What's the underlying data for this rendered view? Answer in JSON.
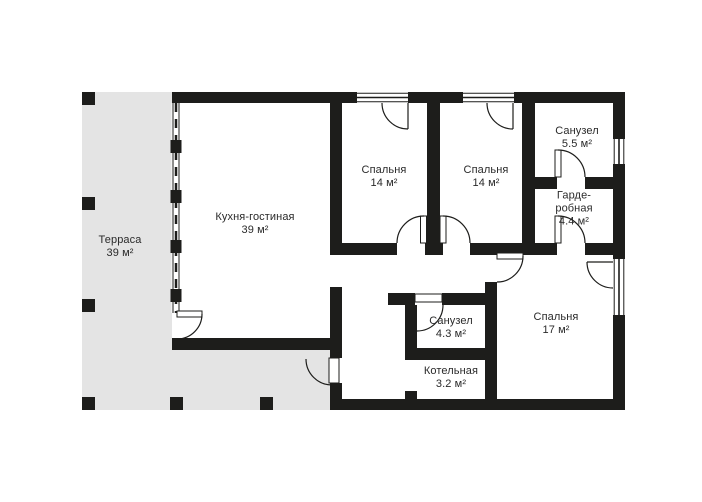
{
  "plan": {
    "colors": {
      "wall": "#1d1d1b",
      "terrace": "#e4e4e4",
      "floor": "#ffffff",
      "ink": "#2a2a2a"
    },
    "rooms": [
      {
        "id": "terrace",
        "name": "Терраса",
        "area": "39 м²",
        "lines": [
          "Терраса",
          "39 м²"
        ]
      },
      {
        "id": "kitchen-living",
        "name": "Кухня-гостиная",
        "area": "39 м²",
        "lines": [
          "Кухня-гостиная",
          "39 м²"
        ]
      },
      {
        "id": "bedroom-1",
        "name": "Спальня",
        "area": "14 м²",
        "lines": [
          "Спальня",
          "14 м²"
        ]
      },
      {
        "id": "bedroom-2",
        "name": "Спальня",
        "area": "14 м²",
        "lines": [
          "Спальня",
          "14 м²"
        ]
      },
      {
        "id": "bathroom-1",
        "name": "Санузел",
        "area": "5.5 м²",
        "lines": [
          "Санузел",
          "5.5 м²"
        ]
      },
      {
        "id": "wardrobe",
        "name": "Гардеробная",
        "area": "4.4 м²",
        "lines": [
          "Гарде-",
          "робная",
          "4.4 м²"
        ]
      },
      {
        "id": "bedroom-3",
        "name": "Спальня",
        "area": "17 м²",
        "lines": [
          "Спальня",
          "17 м²"
        ]
      },
      {
        "id": "bathroom-2",
        "name": "Санузел",
        "area": "4.3 м²",
        "lines": [
          "Санузел",
          "4.3 м²"
        ]
      },
      {
        "id": "boiler-room",
        "name": "Котельная",
        "area": "3.2 м²",
        "lines": [
          "Котельная",
          "3.2 м²"
        ]
      }
    ]
  }
}
